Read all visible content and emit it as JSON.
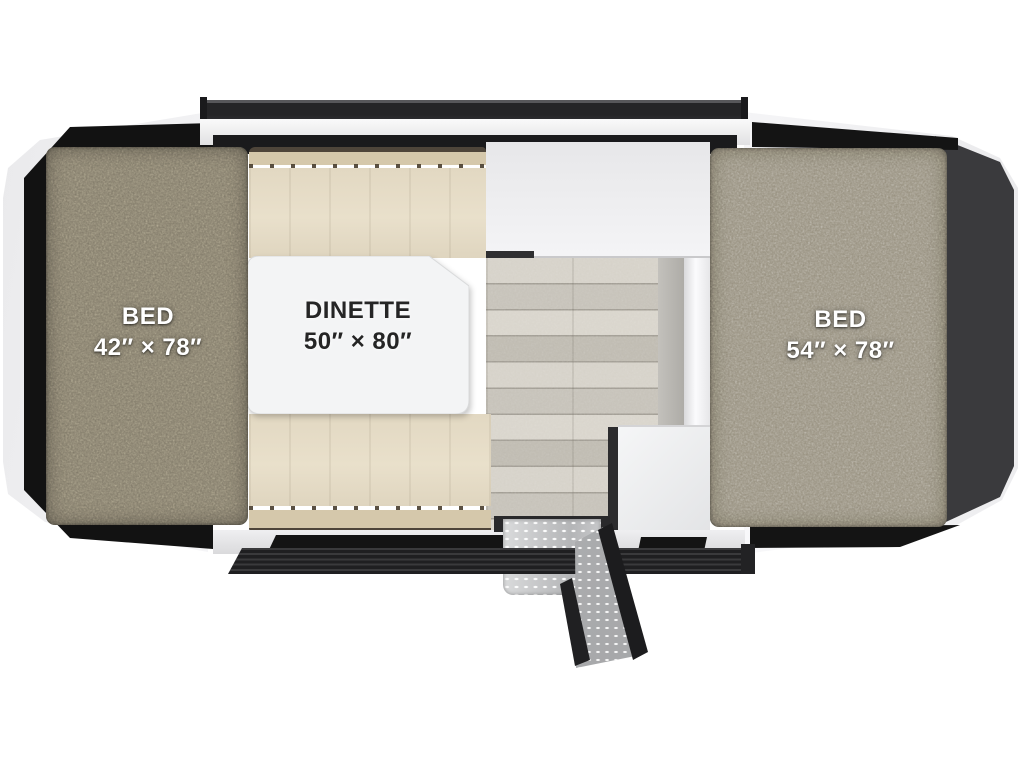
{
  "floorplan": {
    "kind": "popup-camper-top-view",
    "labels": {
      "bed_left": {
        "name": "BED",
        "size": "42″ × 78″"
      },
      "dinette": {
        "name": "DINETTE",
        "size": "50″ × 80″"
      },
      "bed_right": {
        "name": "BED",
        "size": "54″ × 78″"
      }
    },
    "palette": {
      "background": "#ffffff",
      "body_trim_white": "#f2f2f4",
      "tent_fabric_dark": "#141414",
      "tent_panel_charcoal": "#3a3a3d",
      "roof_rail": "#252527",
      "carpet_left": "#827b6a",
      "carpet_right": "#97907f",
      "bench_cushion": "#e5dbc6",
      "bench_backrest": "#d5c8ab",
      "bench_seam": "#4e453a",
      "table_top": "#f3f4f5",
      "wood_floor": "#ccc8bf",
      "counter": "#ededef",
      "cabinet": "#eef0f1",
      "bumper_rail": "#29292b",
      "step_metal": "#c7c8ca"
    }
  }
}
